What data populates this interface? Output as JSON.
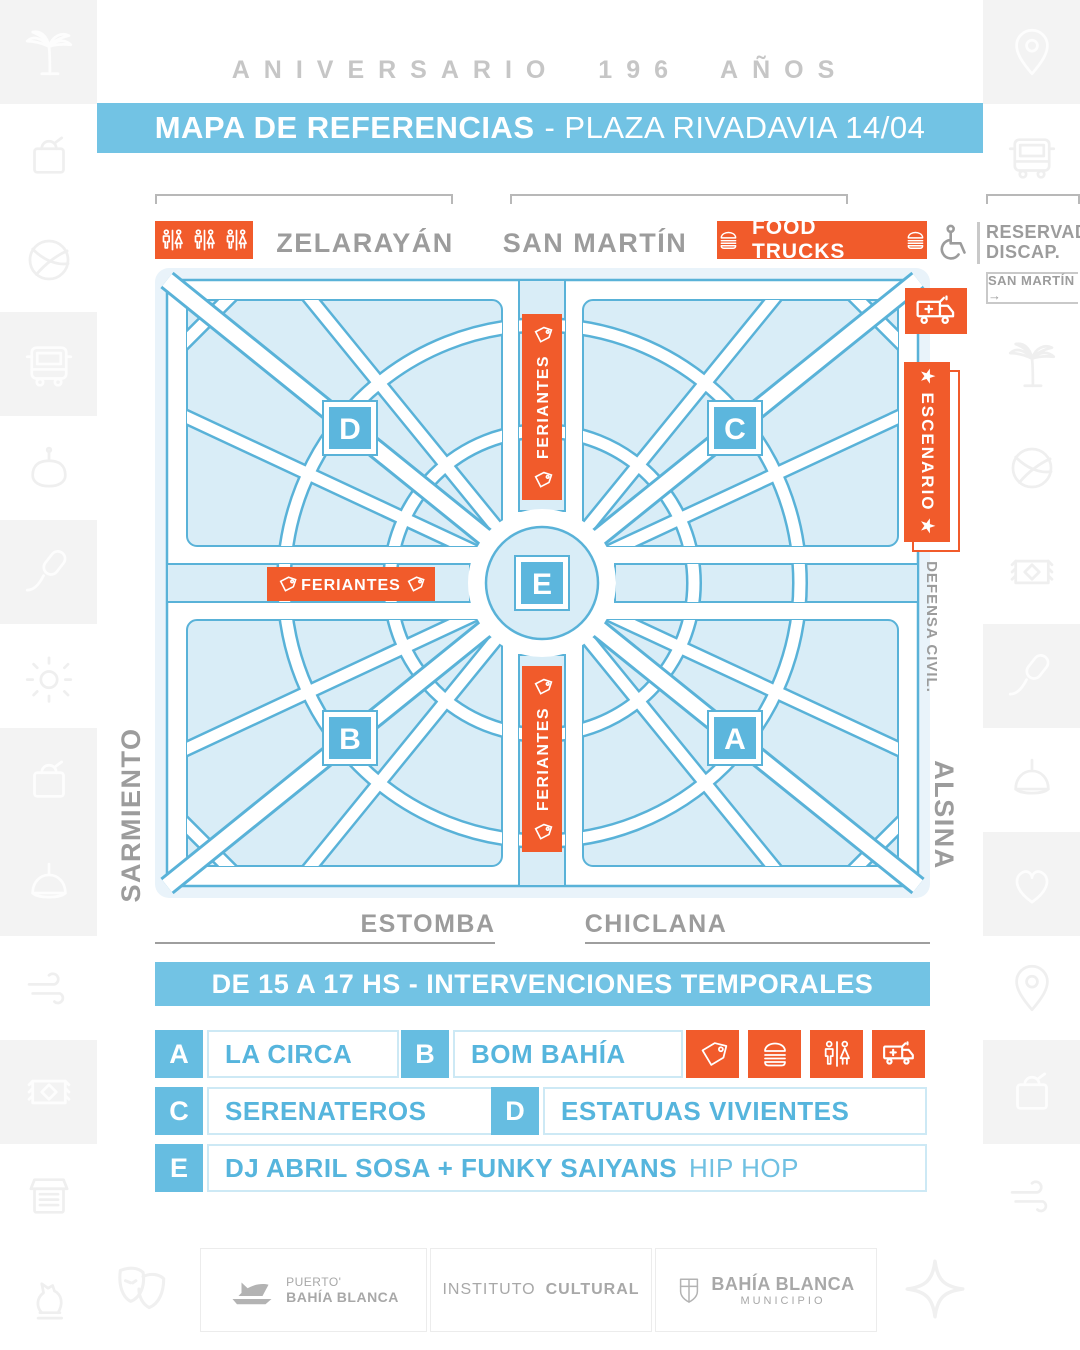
{
  "header": {
    "kicker": "ANIVERSARIO 196 AÑOS",
    "title_bold": "MAPA DE REFERENCIAS",
    "title_rest": "- PLAZA RIVADAVIA 14/04"
  },
  "streets": {
    "top_left": "ZELARAYÁN",
    "top_right": "SAN MARTÍN",
    "left": "SARMIENTO",
    "right": "ALSINA",
    "bottom_left": "ESTOMBA",
    "bottom_right": "CHICLANA",
    "right_note": "SAN MARTÍN →"
  },
  "labels": {
    "food_trucks": "FOOD TRUCKS",
    "feriantes": "FERIANTES",
    "escenario": "★  ESCENARIO  ★",
    "defensa_civil": "DEFENSA CIVIL.",
    "reservado_line1": "RESERVADO",
    "reservado_line2": "DISCAP."
  },
  "map": {
    "markers": [
      "D",
      "C",
      "B",
      "A",
      "E"
    ]
  },
  "schedule": {
    "banner": "DE 15 A 17 HS - INTERVENCIONES TEMPORALES",
    "items": [
      {
        "letter": "A",
        "name": "LA CIRCA"
      },
      {
        "letter": "B",
        "name": "BOM BAHÍA"
      },
      {
        "letter": "C",
        "name": "SERENATEROS"
      },
      {
        "letter": "D",
        "name": "ESTATUAS VIVIENTES"
      },
      {
        "letter": "E",
        "name": "DJ ABRIL SOSA  +  FUNKY SAIYANS",
        "suffix": "HIP HOP"
      }
    ],
    "legend_icons": [
      "tag",
      "food-truck-burger",
      "restrooms",
      "ambulance"
    ]
  },
  "footer": {
    "logo1_line1": "PUERTO'",
    "logo1_line2": "BAHÍA BLANCA",
    "logo2_normal": "INSTITUTO ",
    "logo2_bold": "CULTURAL",
    "logo3_line1": "BAHÍA BLANCA",
    "logo3_line2": "MUNICIPIO"
  },
  "rails": {
    "left_icons": [
      "palm-tree",
      "shopping-bag",
      "basketball",
      "bus",
      "cooking-pot",
      "microphone",
      "sun",
      "shopping-bag",
      "hanging-lamp",
      "wind",
      "rug",
      "market-truck",
      "chess-knight"
    ],
    "right_icons": [
      "location-pin",
      "bus",
      "",
      "palm-tree",
      "basketball",
      "rug",
      "microphone",
      "hanging-lamp",
      "heart",
      "location-pin",
      "shopping-bag",
      "wind",
      ""
    ]
  },
  "colors": {
    "orange": "#f15b2b",
    "sky_blue": "#72c3e4",
    "marker_blue": "#5cb6dd",
    "map_fill": "#d9edf7",
    "map_stroke": "#59b2d8",
    "gray_text": "#9c9c9c"
  }
}
